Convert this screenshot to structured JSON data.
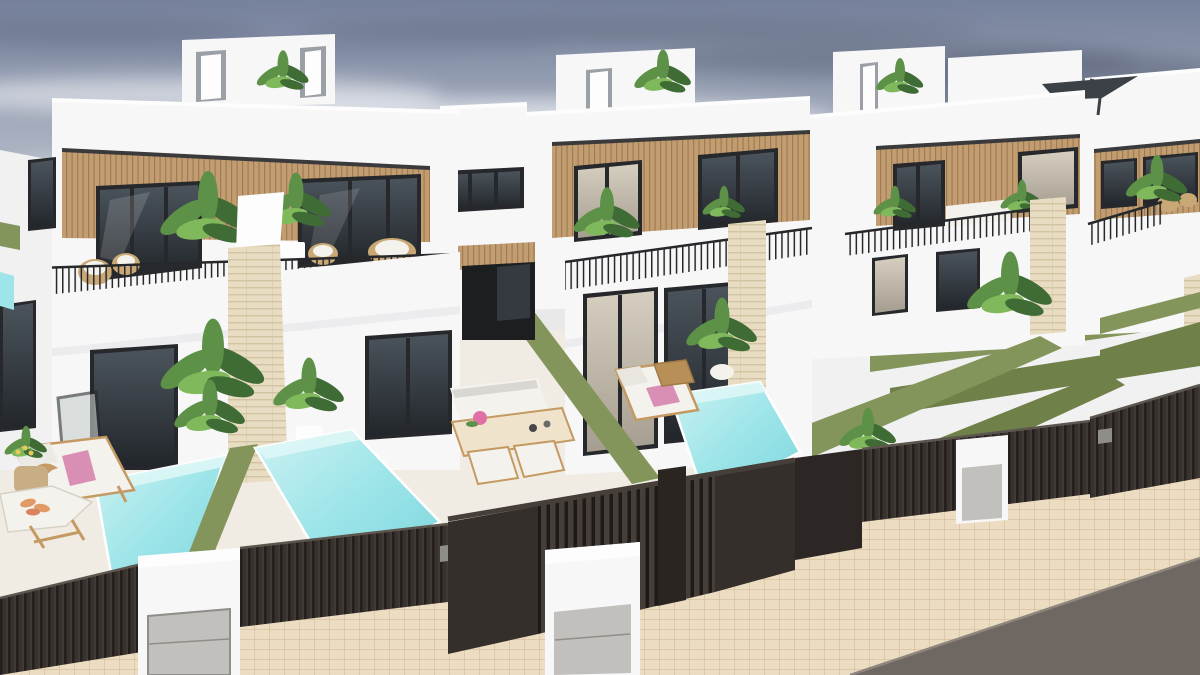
{
  "scene": {
    "type": "architectural-3d-render",
    "description": "Aerial street-corner view of a row of newly built modern two-storey white villas with rooftop terraces, wood-slat facade bands, black-framed glazing, balconies with dark metal railings, travertine pillars, artificial-grass boundary walls, private turquoise plunge pools, dark slatted street fences with white letterbox pillars, a beige tiled sidewalk and a grey road in the foreground",
    "sky": "hazy blue-grey sky with streaky clouds, darker storm-grey patch upper right, green countryside strip on the far right horizon",
    "houses_visible": 5
  },
  "inventory": {
    "left_villa": [
      "rooftop terrace box with two access doors and plant",
      "wood-slat upper band with two sliding windows",
      "balcony with wicker chairs, palms and black railing",
      "white-capped travertine pillar",
      "ground-floor glazing with open door",
      "garden palms and white planter"
    ],
    "middle_villa": [
      "rooftop box with door and plant",
      "wood-slat band with curtained and dark windows",
      "balcony with plants and railing",
      "travertine pillar",
      "sun lounger with pink towel",
      "potted palm",
      "turquoise plunge pool"
    ],
    "right_villa": [
      "two rooftop boxes with door and plant",
      "rooftop AC unit",
      "wood-slat band windows",
      "balcony sofa and plant",
      "travertine pillar",
      "tall palm"
    ],
    "far_right_villa": [
      "cantilever parasol on roof terrace",
      "balcony with plant and wicker seats",
      "travertine edge pillar"
    ],
    "left_neighbour_yard": [
      "sun lounger with pink towel",
      "plant table with tan vase and yellow flowers",
      "driftwood bird ornament",
      "tray table with croissants",
      "plunge pool"
    ],
    "left_villa_yard": [
      "plunge pool",
      "outdoor sofa",
      "dining table with two chairs",
      "pink flower centrepiece"
    ],
    "street": [
      "dark slatted fence sections",
      "slatted garage gate with post",
      "three white entrance pillars with metal letterbox panels",
      "two small gate plaques",
      "artificial grass boundary walls",
      "beige tiled sidewalk",
      "grey asphalt road"
    ]
  },
  "colors": {
    "skyTop": "#76819c",
    "skyMid": "#aeb6c4",
    "skyHorizon": "#e9e9ea",
    "cloudDark": "#5c6579",
    "cloudMid": "#76829c",
    "cloudLight": "#ffffff",
    "field": "#8a9a55",
    "wall": "#f7f7f7",
    "wallBright": "#fdfdfe",
    "wallShade": "#e7e7ea",
    "wallDim": "#f1f1f2",
    "trimDark": "#3a3a3c",
    "wood": "#c29d72",
    "woodLine": "#a07c50",
    "frame": "#26282b",
    "glassDark1": "#4b545c",
    "glassDark2": "#22262b",
    "glassLight1": "#d6cfc0",
    "glassLight2": "#a59e90",
    "grass": "#84955c",
    "grassDeep": "#6f8049",
    "poolLight": "#cdf1f2",
    "poolMid": "#9de5e9",
    "poolDeep": "#7cd6dd",
    "poolWall": "#ddf6f6",
    "trav": "#e8ddc2",
    "travLine": "#d2c3a2",
    "fence": "#38322e",
    "fenceLine": "#241f1d",
    "fenceDark": "#2c2724",
    "gateSlat": "#453e39",
    "gateGap": "#1d1a18",
    "fenceTop": "#5d564f",
    "metal": "#c2c0bc",
    "metalFrame": "#8f8d89",
    "sidewalk": "#ecdcc2",
    "paveLine": "#d3bb97",
    "road": "#6f6761",
    "roadEdge": "#8d857e",
    "ground": "#f1ece3",
    "furnWood": "#c49a62",
    "cushion": "#f4f2ed",
    "cushionGray": "#d9d7d2",
    "towel": "#d98fb4",
    "flower": "#e06fa8",
    "wicker": "#c9a876",
    "pot": "#c9ad85",
    "croissant": "#e09a66",
    "plant1": "#3f6b35",
    "plant2": "#5d9147",
    "plant3": "#7fb95c",
    "parasol": "#3c4148",
    "acUnit": "#5f6773",
    "doorFrameGrey": "#9aa0a6",
    "corridorDark": "#1c1e20",
    "corridorGlass": "#343a3f"
  }
}
